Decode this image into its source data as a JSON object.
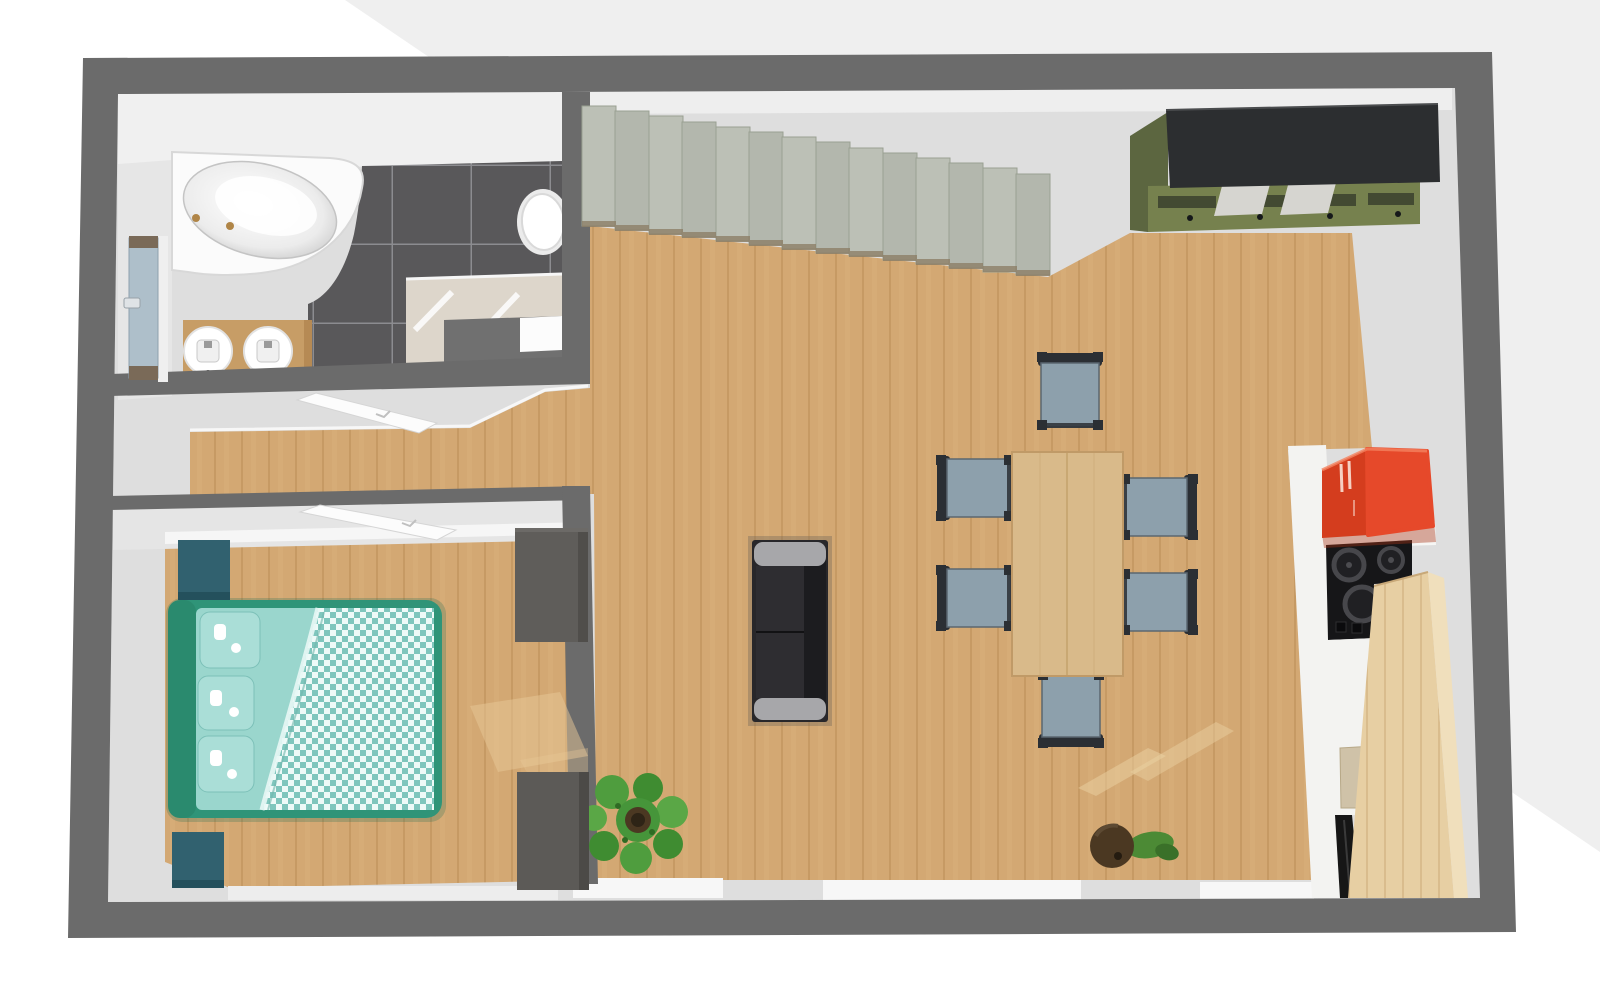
{
  "scene": {
    "type": "apartment-floor-plan-3d-top-view",
    "rooms": [
      {
        "name": "bathroom",
        "objects": [
          "corner-bathtub",
          "double-sink-vanity",
          "toilet",
          "walk-in-shower",
          "entry-door"
        ]
      },
      {
        "name": "hallway",
        "objects": [
          "open-door-panel",
          "wood-corridor"
        ]
      },
      {
        "name": "bedroom",
        "objects": [
          "double-bed",
          "nightstand",
          "nightstand",
          "dresser",
          "dresser",
          "open-door-panel"
        ]
      },
      {
        "name": "living-dining",
        "objects": [
          "staircase",
          "wardrobe-cabinet",
          "dining-table",
          "dining-chair",
          "dining-chair",
          "dining-chair",
          "dining-chair",
          "dining-chair",
          "dining-chair",
          "sofa",
          "plant-large",
          "plant-small"
        ]
      },
      {
        "name": "kitchen",
        "objects": [
          "red-wall-cabinet",
          "cooktop",
          "white-counter",
          "sink-cutout",
          "dishwasher",
          "wood-counter"
        ]
      }
    ],
    "counts": {
      "dining_chairs": 6,
      "stair_steps": 14,
      "sinks": 2,
      "pillows": 3
    }
  },
  "colors": {
    "bg": "#ffffff",
    "bg_wedge": "#efefef",
    "wall": "#6b6b6b",
    "wall_face_light": "#efefef",
    "floor_gray": "#dedede",
    "wood": "#d3a873",
    "wood_line": "#c1955e",
    "wood_table": "#d9ba8a",
    "wood_counter": "#e7cfa3",
    "wood_counter_side": "#f0dfbc",
    "tile": "#59585a",
    "tile_grout": "#8c8c90",
    "tub": "#fbfbfb",
    "shower_beige": "#ddd6cb",
    "shower_tray": "#707070",
    "vanity_wood": "#c79d66",
    "door_blue": "#aebfca",
    "stair": "#bcc0b6",
    "stair_alt": "#b3b7ad",
    "stair_shadow": "#8a7b63",
    "bed_green": "#2f9478",
    "duvet_teal": "#7fc6bd",
    "duvet_check_light": "#eefaf8",
    "teal_cabinet": "#31616f",
    "dresser_gray": "#5f5d5a",
    "chair_seat": "#8da0ac",
    "chair_frame": "#2b2f34",
    "sofa_body": "#28272a",
    "sofa_arm": "#a7a7aa",
    "sofa_back": "#1c1c1f",
    "olive": "#76814e",
    "olive_dark": "#5c6640",
    "cabinet_top": "#2c2e30",
    "cabinet_insert": "#d6d5d0",
    "red_front": "#d43d1e",
    "red_side": "#e6492a",
    "cooktop": "#161618",
    "burner_ring": "#47474b",
    "counter_white": "#f3f3f1",
    "cutout": "#cfc2a8",
    "plant_green": "#4f9d3e",
    "plant_green_dark": "#3f8c31",
    "plant_green_light": "#5aa746",
    "pot_brown": "#4b3822",
    "pot_dark": "#2e2416"
  }
}
